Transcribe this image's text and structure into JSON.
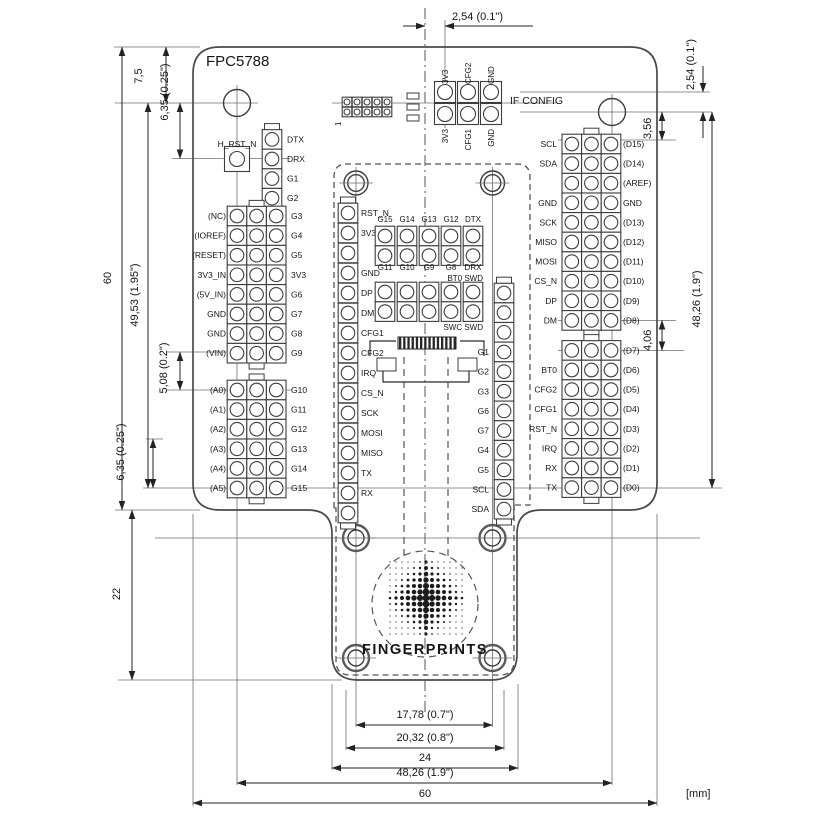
{
  "title": "FPC5788",
  "logo_text": "FINGERPRINTS",
  "units_label": "[mm]",
  "if_config": {
    "label": "IF CONFIG",
    "top_pins": [
      "3V3",
      "CFG2",
      "GND"
    ],
    "bottom_pins": [
      "3V3",
      "CFG1",
      "GND"
    ],
    "aux_pin1_label": "1"
  },
  "arduino_left": {
    "h_rst_label": "H_RST_N",
    "serial_column": [
      "DTX",
      "DRX",
      "G1",
      "G2"
    ],
    "power_header": {
      "left": [
        "(NC)",
        "(IOREF)",
        "(RESET)",
        "3V3_IN",
        "(5V_IN)",
        "GND",
        "GND",
        "(VIN)"
      ],
      "right": [
        "G3",
        "G4",
        "G5",
        "3V3",
        "G6",
        "G7",
        "G8",
        "G9"
      ]
    },
    "analog_header": {
      "left": [
        "(A0)",
        "(A1)",
        "(A2)",
        "(A3)",
        "(A4)",
        "(A5)"
      ],
      "right": [
        "G10",
        "G11",
        "G12",
        "G13",
        "G14",
        "G15"
      ]
    }
  },
  "arduino_right": {
    "upper_header": {
      "left": [
        "SCL",
        "SDA",
        "",
        "GND",
        "SCK",
        "MISO",
        "MOSI",
        "CS_N",
        "DP",
        "DM"
      ],
      "right": [
        "(D15)",
        "(D14)",
        "(AREF)",
        "GND",
        "(D13)",
        "(D12)",
        "(D11)",
        "(D10)",
        "(D9)",
        "(D8)"
      ]
    },
    "lower_header": {
      "left": [
        "",
        "BT0",
        "CFG2",
        "CFG1",
        "RST_N",
        "IRQ",
        "RX",
        "TX"
      ],
      "right": [
        "(D7)",
        "(D6)",
        "(D5)",
        "(D4)",
        "(D3)",
        "(D2)",
        "(D1)",
        "(D0)"
      ]
    }
  },
  "module": {
    "left_column": [
      "RST_N",
      "3V3",
      "",
      "GND",
      "DP",
      "DM",
      "CFG1",
      "CFG2",
      "IRQ",
      "CS_N",
      "SCK",
      "MOSI",
      "MISO",
      "TX",
      "RX",
      ""
    ],
    "right_column": [
      "",
      "",
      "",
      "G1",
      "G2",
      "G3",
      "G6",
      "G7",
      "G4",
      "G5",
      "SCL",
      "SDA"
    ],
    "gpio_header_top": [
      "G15",
      "G14",
      "G13",
      "G12",
      "DTX"
    ],
    "gpio_header_bottom": [
      "G11",
      "G10",
      "G9",
      "G8",
      "DRX"
    ],
    "swd_label_top": "BT0 SWD",
    "swd_label_bottom": "SWC SWD"
  },
  "dimensions": {
    "top_pitch": "2,54 (0.1\")",
    "right_pitch": "2,54 (0.1\")",
    "right_offset": "3,56",
    "right_span": "48,26 (1.9\")",
    "right_gap": "4,06",
    "left_top_offset": "7,5",
    "left_upper_offset": "6,35 (0.25\")",
    "left_height": "60",
    "left_span": "49,53 (1.95\")",
    "left_gap": "5,08 (0.2\")",
    "left_lower_offset": "6,35 (0.25\")",
    "tail_height": "22",
    "bottom_sensor_holes": "17,78 (0.7\")",
    "bottom_sensor_width": "20,32 (0.8\")",
    "bottom_tail_width": "24",
    "bottom_hole_span": "48,26 (1.9\")",
    "bottom_width": "60"
  }
}
